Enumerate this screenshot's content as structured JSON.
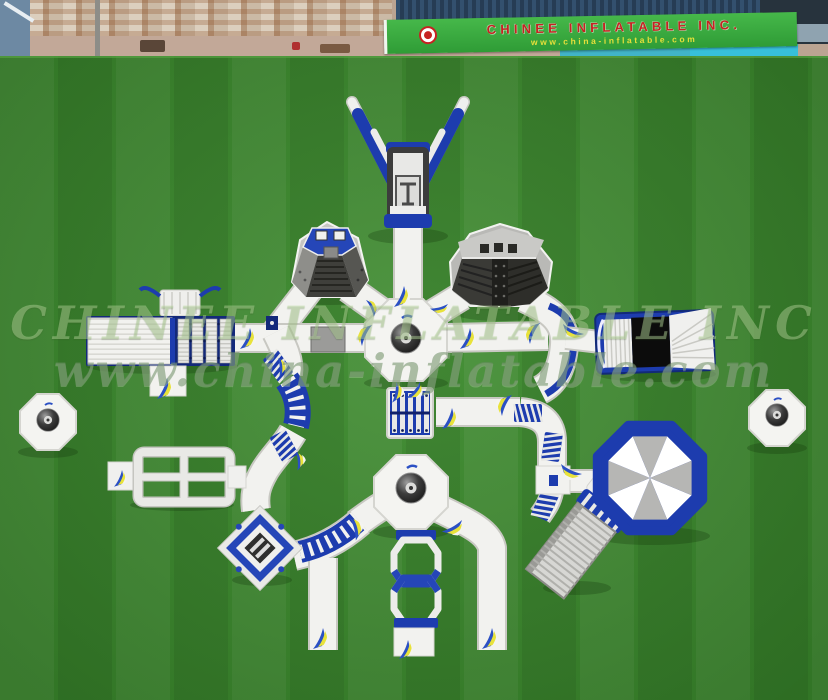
{
  "banner": {
    "company": "CHINEE INFLATABLE INC.",
    "website": "www.china-inflatable.com"
  },
  "watermark": {
    "line1": "CHINEE INFLATABLE INC",
    "line2": "www.china-inflatable.com"
  },
  "colors": {
    "grass": "#3e8c2f",
    "banner_green": "#3cae3e",
    "banner_text_red": "#c62222",
    "banner_url_yellow": "#e6df3a",
    "inflatable_white": "#f2f2ef",
    "inflatable_blue": "#1d3cae",
    "slide_silver": "#d7d7d4",
    "structure_dark": "#3f3f3b",
    "umbrella_gray": "#b6b6b4",
    "roof_rust": "#c4a98e",
    "roof_blue": "#33506e",
    "wall_teal": "#41b4c8"
  }
}
